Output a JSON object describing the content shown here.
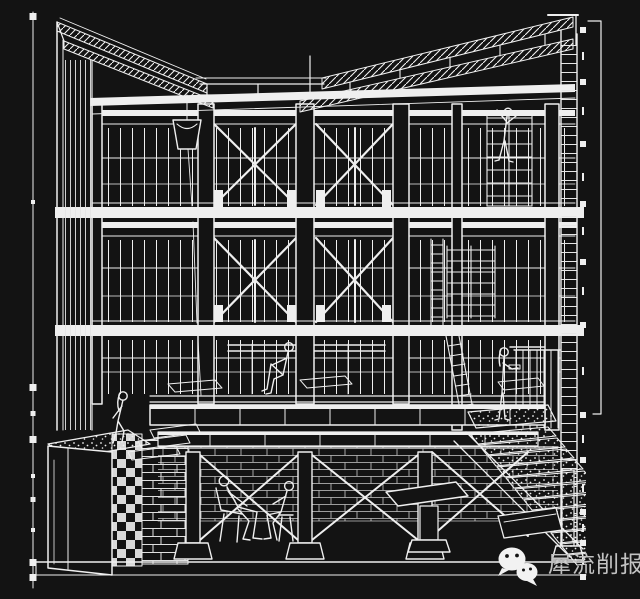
{
  "theme": {
    "bg": "#131313",
    "line": "#efefef",
    "wm": "#c2c2c2"
  },
  "drawing": {
    "type": "architectural-sectional-perspective",
    "title": "Black-and-white sectional perspective line drawing of a multi-storey timber-frame building with butterfly roof trusses, cross-braced window walls, rain chain with bucket, raised platform, basement, planter, stairs and human figures",
    "storeys_visible": 4,
    "elements": [
      "butterfly-roof-truss",
      "eave-beam",
      "cross-braced-window-wall",
      "floor-slab",
      "rain-chain-with-bucket",
      "shelving-unit",
      "ladder",
      "raised-platform",
      "gravel-planter",
      "masonry-basement",
      "grand-stair",
      "dimension-tick-line"
    ],
    "figures_count": 6
  },
  "annotations": {
    "left_dimension_line": {
      "ticks": 10
    },
    "right_tick_line": {
      "ticks": 11
    },
    "right_dimension_line": {
      "capped_top": true,
      "capped_bottom": true
    }
  },
  "watermark": {
    "icon": "wechat-icon",
    "text": "犀流削报"
  }
}
